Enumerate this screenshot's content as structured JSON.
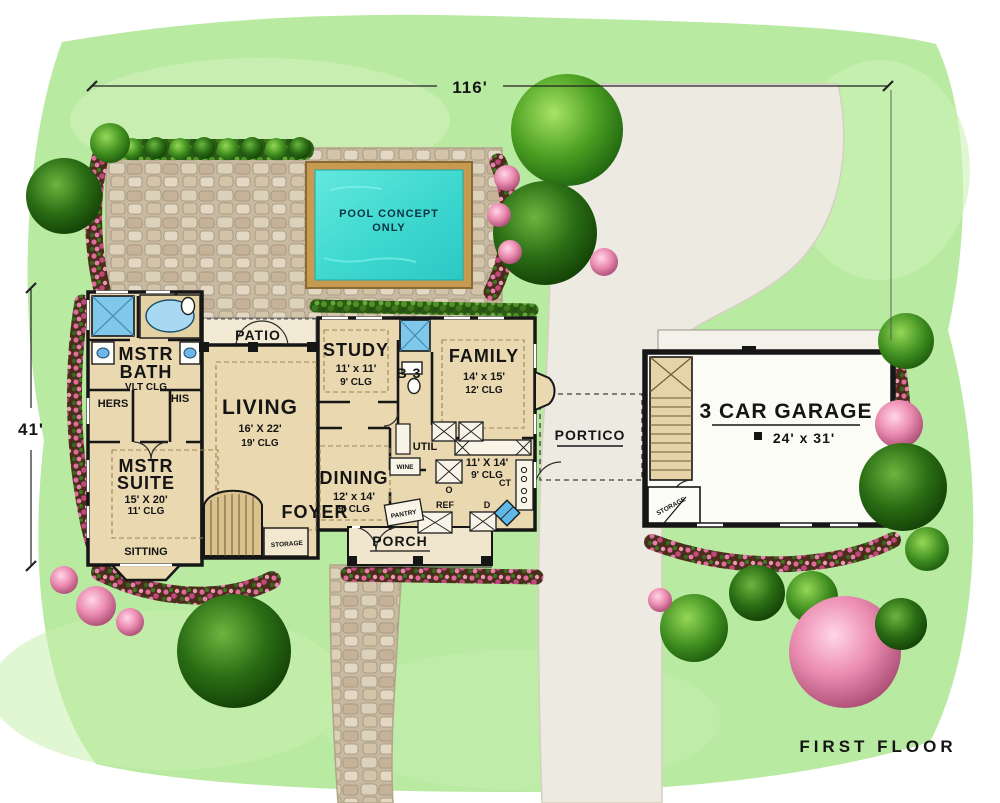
{
  "page_title": "FIRST  FLOOR",
  "dimensions": {
    "overall_width": "116'",
    "overall_depth": "41'"
  },
  "pool": {
    "label_line1": "POOL CONCEPT",
    "label_line2": "ONLY"
  },
  "rooms": {
    "mstr_bath": {
      "line1": "MSTR",
      "line2": "BATH",
      "clg": "VLT CLG"
    },
    "hers": {
      "label": "HERS"
    },
    "his": {
      "label": "HIS"
    },
    "mstr_suite": {
      "line1": "MSTR",
      "line2": "SUITE",
      "size": "15' X 20'",
      "clg": "11' CLG"
    },
    "sitting": {
      "label": "SITTING"
    },
    "living": {
      "label": "LIVING",
      "size": "16' X 22'",
      "clg": "19' CLG"
    },
    "patio": {
      "label": "PATIO"
    },
    "study": {
      "label": "STUDY",
      "size": "11' x 11'",
      "clg": "9' CLG"
    },
    "bath3": {
      "label": "B 3"
    },
    "family": {
      "label": "FAMILY",
      "size": "14' x 15'",
      "clg": "12' CLG"
    },
    "dining": {
      "label": "DINING",
      "size": "12' x 14'",
      "clg": "9' CLG"
    },
    "util": {
      "label": "UTIL"
    },
    "kitchen": {
      "size": "11' X 14'",
      "clg": "9' CLG"
    },
    "foyer": {
      "label": "FOYER"
    },
    "porch": {
      "label": "PORCH"
    },
    "portico": {
      "label": "PORTICO"
    },
    "garage": {
      "label": "3 CAR GARAGE",
      "size": "24' x 31'"
    },
    "storage_foyer": {
      "label": "STORAGE"
    },
    "storage_garage": {
      "label": "STORAGE"
    }
  },
  "fixtures": {
    "wine": "WINE",
    "pantry": "PANTRY",
    "ref": "REF",
    "oven": "O",
    "dishwasher": "D",
    "cooktop": "CT"
  },
  "colors": {
    "floor_tan": "#ead9b0",
    "wall": "#161616",
    "pool_water": "#45ded6",
    "grass": "#b9eaa2",
    "stone": "#d3c5ac",
    "drive": "#edeae2"
  }
}
